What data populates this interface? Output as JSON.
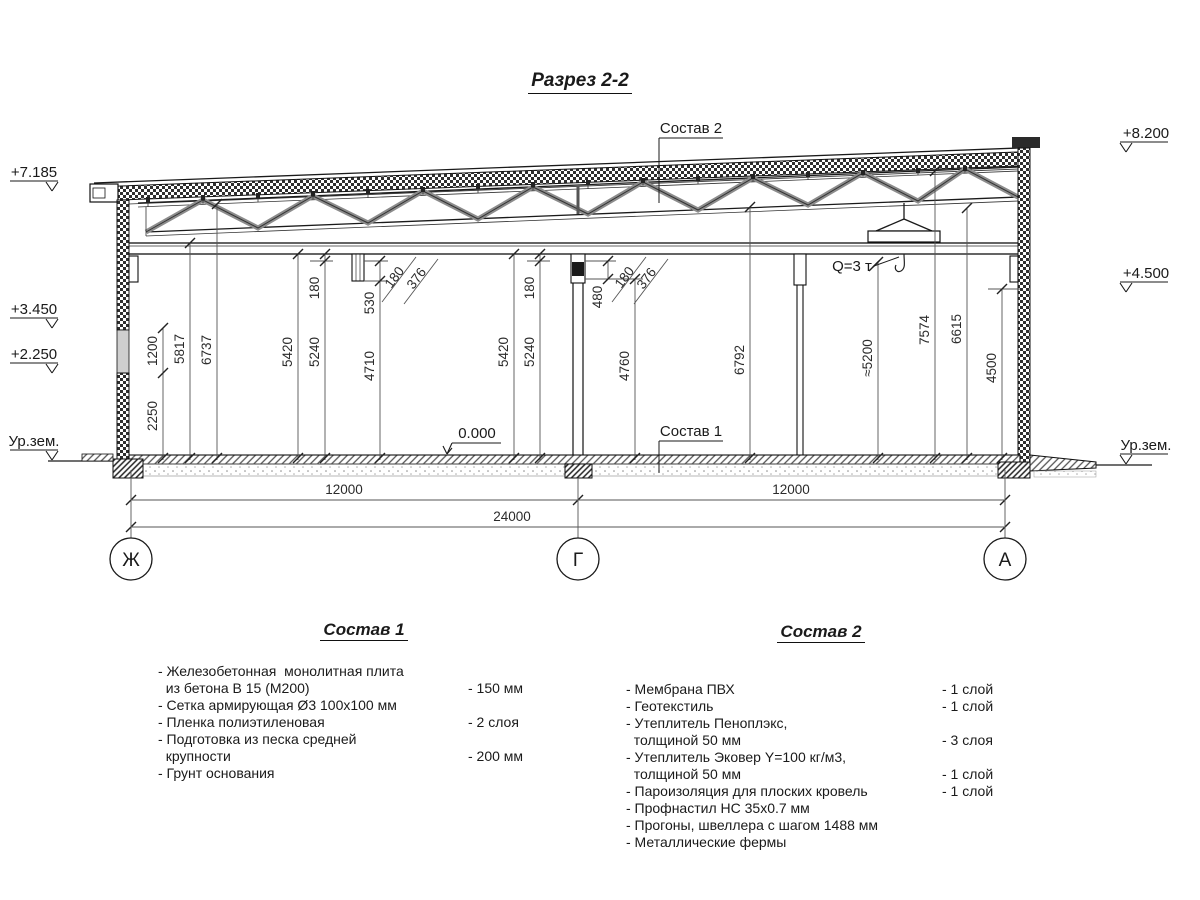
{
  "title": "Разрез 2-2",
  "callouts": {
    "composition1": "Состав 1",
    "composition2": "Состав 2",
    "crane": "Q=3 т",
    "floor": "0.000"
  },
  "elevations": {
    "left": [
      "+7.185",
      "+3.450",
      "+2.250",
      "Ур.зем."
    ],
    "right": [
      "+8.200",
      "+4.500",
      "Ур.зем."
    ]
  },
  "axes": [
    "Ж",
    "Г",
    "А"
  ],
  "dims": {
    "horizontal": {
      "bay1": "12000",
      "total": "24000",
      "bay2": "12000"
    },
    "vertical": {
      "d2250": "2250",
      "d1200": "1200",
      "d5817": "5817",
      "d6737": "6737",
      "d5420a": "5420",
      "d5240a": "5240",
      "d180a": "180",
      "d530": "530",
      "d180b": "180",
      "d376a": "376",
      "d4710": "4710",
      "d5420b": "5420",
      "d5240b": "5240",
      "d180c": "180",
      "d480": "480",
      "d180d": "180",
      "d376b": "376",
      "d4760": "4760",
      "d6792": "6792",
      "d5200": "≈5200",
      "d7574": "7574",
      "d6615": "6615",
      "d4500": "4500"
    }
  },
  "composition1": {
    "title": "Состав 1",
    "items": [
      {
        "text": "- Железобетонная  монолитная плита\n  из бетона В 15 (М200)",
        "qty": "- 150 мм"
      },
      {
        "text": "- Сетка армирующая Ø3 100х100 мм",
        "qty": ""
      },
      {
        "text": "- Пленка полиэтиленовая",
        "qty": "-  2 слоя"
      },
      {
        "text": "- Подготовка из песка средней\n  крупности",
        "qty": "- 200 мм"
      },
      {
        "text": "- Грунт основания",
        "qty": ""
      }
    ]
  },
  "composition2": {
    "title": "Состав 2",
    "items": [
      {
        "text": "- Мембрана ПВХ",
        "qty": "- 1 слой"
      },
      {
        "text": "- Геотекстиль",
        "qty": "- 1 слой"
      },
      {
        "text": "- Утеплитель Пеноплэкс,\n  толщиной 50 мм",
        "qty": "- 3 слоя"
      },
      {
        "text": "- Утеплитель Эковер Y=100 кг/м3,\n  толщиной 50 мм",
        "qty": "- 1 слой"
      },
      {
        "text": "- Пароизоляция для плоских кровель",
        "qty": "- 1 слой"
      },
      {
        "text": "- Профнастил НС 35х0.7 мм",
        "qty": ""
      },
      {
        "text": "- Прогоны, швеллера с шагом 1488 мм",
        "qty": ""
      },
      {
        "text": "- Металлические фермы",
        "qty": ""
      }
    ]
  }
}
